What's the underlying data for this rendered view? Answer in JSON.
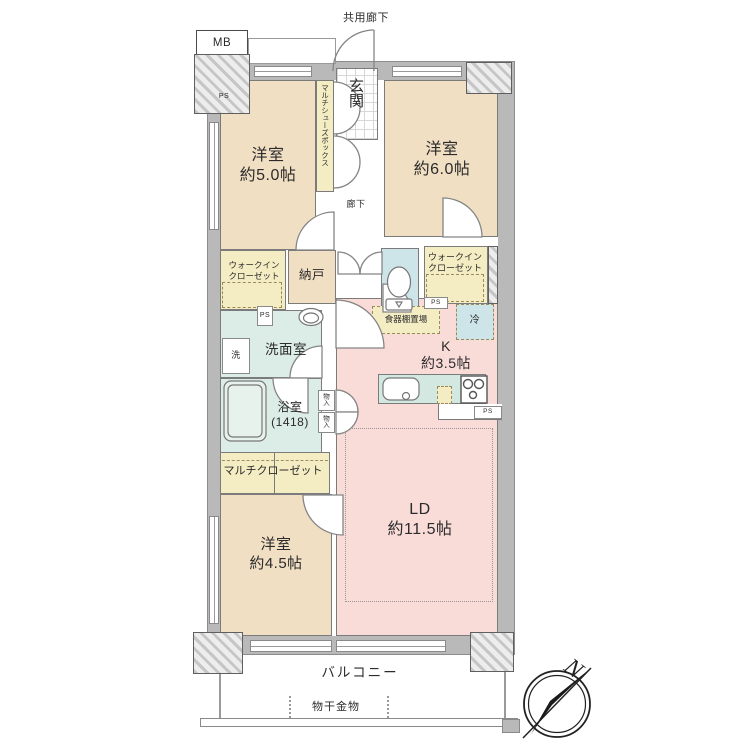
{
  "colors": {
    "bedroom_beige": "#f1dfc4",
    "ldk_pink": "#f9dcd8",
    "closet_yellow": "#f4ecc3",
    "wet_area_teal": "#dcece6",
    "cold_blue": "#cde4e8",
    "wall_gray": "#b9b9b9"
  },
  "exterior": {
    "common_corridor": "共用廊下",
    "meter_box": "MB",
    "balcony": "バルコニー",
    "laundry_hardware": "物干金物",
    "north": "N"
  },
  "entrance": {
    "genkan": "玄関",
    "shoe_box": "マルチシューズボックス",
    "hallway": "廊下"
  },
  "rooms": {
    "bedroom1": {
      "name": "洋室",
      "size": "約5.0帖"
    },
    "bedroom2": {
      "name": "洋室",
      "size": "約6.0帖"
    },
    "bedroom3": {
      "name": "洋室",
      "size": "約4.5帖"
    },
    "living_dining": {
      "name": "LD",
      "size": "約11.5帖"
    },
    "kitchen": {
      "name": "K",
      "size": "約3.5帖"
    },
    "bathroom": {
      "name": "浴室",
      "size": "(1418)"
    },
    "washroom": "洗面室",
    "storage_room": "納戸",
    "walk_in_closet_line1": "ウォークイン",
    "walk_in_closet_line2": "クローゼット",
    "multi_closet": "マルチクローゼット"
  },
  "fixtures": {
    "cupboard_space": "食器棚置場",
    "refrigerator": "冷",
    "washer": "洗",
    "storage": "物入",
    "pipe_space": "PS"
  }
}
